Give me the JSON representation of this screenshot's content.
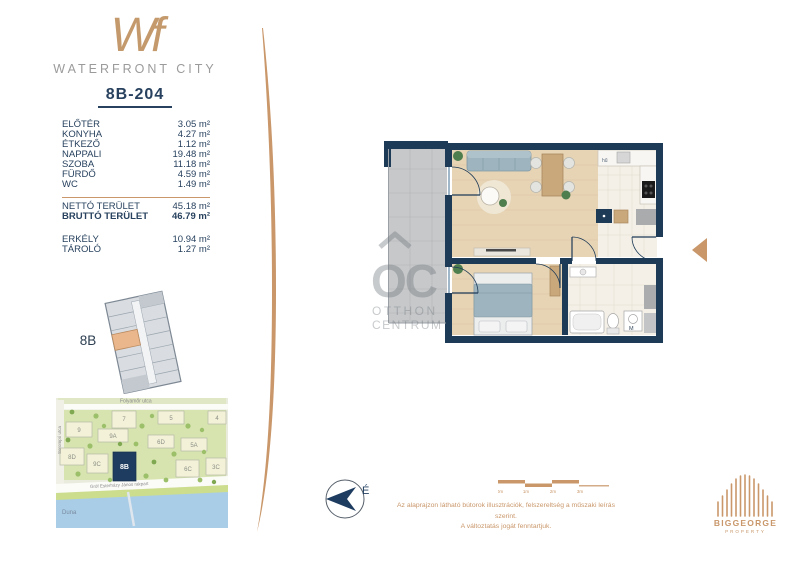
{
  "brand": {
    "monogram": "Wf",
    "name": "WATERFRONT CITY"
  },
  "unit": {
    "id": "8B-204",
    "building_label": "8B"
  },
  "area_table": {
    "rooms": [
      {
        "label": "ELŐTÉR",
        "value": "3.05 m²"
      },
      {
        "label": "KONYHA",
        "value": "4.27 m²"
      },
      {
        "label": "ÉTKEZŐ",
        "value": "1.12 m²"
      },
      {
        "label": "NAPPALI",
        "value": "19.48 m²"
      },
      {
        "label": "SZOBA",
        "value": "11.18 m²"
      },
      {
        "label": "FÜRDŐ",
        "value": "4.59 m²"
      },
      {
        "label": "WC",
        "value": "1.49 m²"
      }
    ],
    "totals": [
      {
        "label": "NETTÓ TERÜLET",
        "value": "45.18 m²"
      },
      {
        "label": "BRUTTÓ TERÜLET",
        "value": "46.79 m²"
      }
    ],
    "extras": [
      {
        "label": "ERKÉLY",
        "value": "10.94 m²"
      },
      {
        "label": "TÁROLÓ",
        "value": "1.27 m²"
      }
    ]
  },
  "map": {
    "streets": {
      "top": "Folyamőr utca",
      "left": "Sorompó utca",
      "embankment": "Gróf Esterházy János rakpart",
      "river": "Duna"
    },
    "buildings": [
      "9",
      "7",
      "5",
      "4",
      "9A",
      "6D",
      "5A",
      "8D",
      "9C",
      "6C",
      "3C"
    ],
    "highlighted": "8B"
  },
  "floorplan": {
    "fridge_label": "hű",
    "washer_label": "M"
  },
  "watermark": {
    "monogram": "OC",
    "line1": "OTTHON",
    "line2": "CENTRUM"
  },
  "compass": {
    "north": "É"
  },
  "scale_bar": {
    "ticks": [
      "0m",
      "1m",
      "2m",
      "3m"
    ]
  },
  "disclaimer": {
    "line1": "Az alaprajzon látható bútorok illusztrációk, felszereltség a műszaki leírás szerint.",
    "line2": "A változtatás jogát fenntartjuk."
  },
  "developer": {
    "name": "BIGGEORGE",
    "division": "PROPERTY"
  },
  "colors": {
    "navy": "#1d3a57",
    "gold": "#c9976a",
    "wood": "#e7d4b5",
    "balcony": "#c6c8ca"
  }
}
